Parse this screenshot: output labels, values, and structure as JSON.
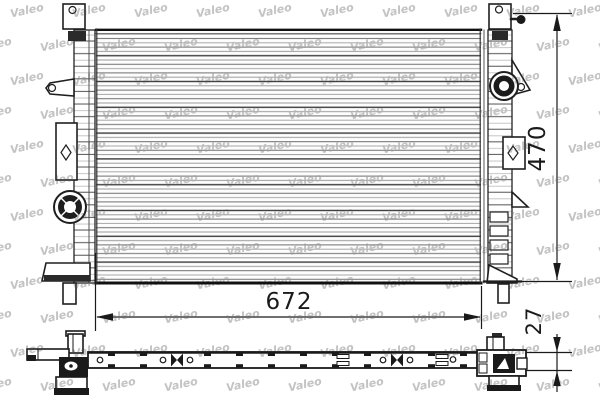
{
  "page": {
    "background_color": "#ffffff",
    "line_color": "#1a1a1a"
  },
  "watermark": {
    "text": "Valeo",
    "color": "#c3c3c3"
  },
  "dimensions": {
    "core_width": {
      "value": "672"
    },
    "core_height": {
      "value": "470"
    },
    "thickness": {
      "value": "27"
    }
  }
}
